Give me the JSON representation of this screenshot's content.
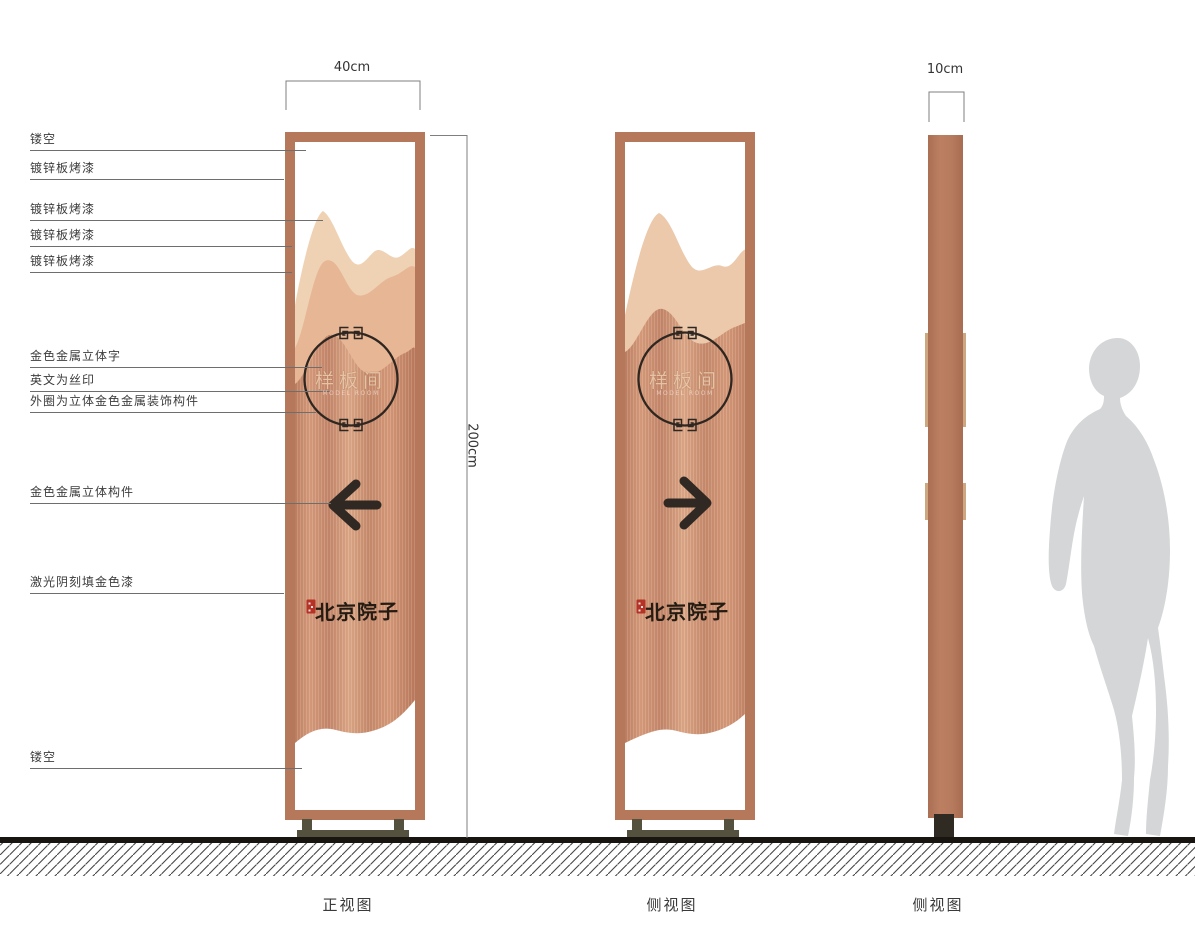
{
  "dimensions": {
    "front_width": "40cm",
    "total_height": "200cm",
    "side_width": "10cm"
  },
  "annotations": [
    {
      "label": "镂空"
    },
    {
      "label": "镀锌板烤漆"
    },
    {
      "label": "镀锌板烤漆"
    },
    {
      "label": "镀锌板烤漆"
    },
    {
      "label": "镀锌板烤漆"
    },
    {
      "label": "金色金属立体字"
    },
    {
      "label": "英文为丝印"
    },
    {
      "label": "外圈为立体金色金属装饰构件"
    },
    {
      "label": "金色金属立体构件"
    },
    {
      "label": "激光阴刻填金色漆"
    },
    {
      "label": "镂空"
    }
  ],
  "sign": {
    "room_label": "样板间",
    "room_label_en": "MODEL ROOM",
    "brand": "北京院子"
  },
  "views": {
    "front": "正视图",
    "side1": "侧视图",
    "side2": "侧视图"
  },
  "colors": {
    "frame_copper": "#b5785b",
    "body_copper_light": "#dca687",
    "body_copper_dark": "#c18163",
    "mountain_light": "#efd2b4",
    "mountain_mid": "#e7b795",
    "accent_dark": "#2e2620",
    "base_olive": "#54523e",
    "seal_red": "#b43226",
    "silhouette_gray": "#d4d6d7"
  }
}
